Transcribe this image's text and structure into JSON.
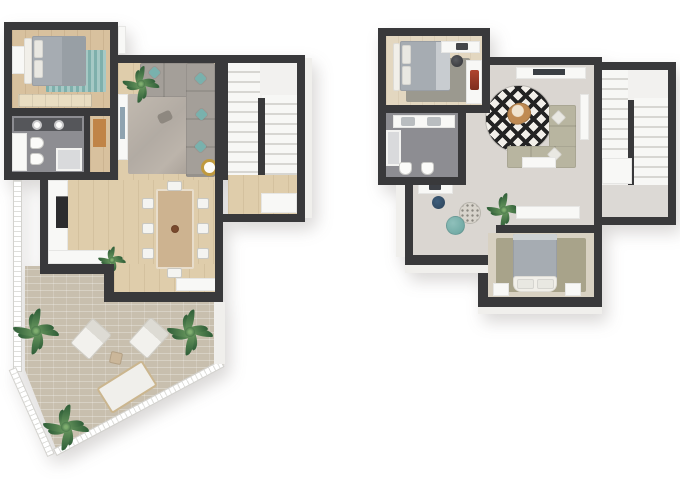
{
  "meta": {
    "image_type": "3d-top-down-floor-plan-render",
    "background": "#ffffff",
    "plan_count": 2
  },
  "palette": {
    "wall": "#39393b",
    "wood": "#d8c19e",
    "wood_light": "#dfcdab",
    "wood_pale": "#e3d7c0",
    "gray_floor": "#8d8d92",
    "light_floor": "#dad6d1",
    "terrace": "#c8bfae",
    "white": "#f8f8f6",
    "exterior": "#f0efec",
    "sofa_gray": "#a49f99",
    "rug_gray": "#b2aba3",
    "rug_dark": "#9b998f",
    "teal": "#79b1ad",
    "navy": "#2c4258",
    "olive": "#b8b5a0",
    "rug_olive": "#a8a38a",
    "tan": "#bf8a52",
    "gold": "#c09a3e",
    "plant_light": "#6b9a60",
    "plant_dark": "#2f5e38",
    "bed_gray": "#a6acb2",
    "appliance": "#2c2c2e",
    "counter_dark": "#55565a",
    "door_wood": "#c08447",
    "step_light": "#f7f7f5",
    "step_shadow": "#d7d6d2"
  },
  "plans": [
    {
      "id": "lower-floor",
      "position": "left",
      "rooms": [
        "bedroom",
        "bathroom",
        "hall-closet",
        "living-room",
        "dining-room",
        "kitchen",
        "staircase",
        "terrace"
      ],
      "furniture": [
        "double-bed",
        "striped-teal-rug",
        "wardrobe",
        "desk",
        "double-sink-vanity",
        "toilet",
        "bidet",
        "shower",
        "corner-sofa",
        "teal-pillows",
        "area-rug",
        "tv-sideboard",
        "gold-side-table",
        "dining-table",
        "dining-chairs-x8",
        "kitchen-tall-units",
        "counter-plant",
        "u-shaped-stairs",
        "palm-plants-x3",
        "lounge-chairs-x2",
        "outdoor-daybed",
        "outdoor-side-table",
        "perimeter-railing"
      ]
    },
    {
      "id": "upper-floor",
      "position": "right",
      "rooms": [
        "bedroom-front",
        "bathroom",
        "lounge",
        "hallway",
        "bedroom-back",
        "staircase"
      ],
      "furniture": [
        "double-bed",
        "dark-rug",
        "desk",
        "desk-chair",
        "wardrobe",
        "double-sink-vanity",
        "shower",
        "toilet",
        "bidet",
        "tv-console",
        "round-diamond-rug",
        "tan-accent-chair",
        "corner-sofa",
        "coffee-table",
        "work-desk",
        "office-chair",
        "teal-pouf",
        "dotted-pouf",
        "plant",
        "sideboard",
        "bed-with-white-headboard",
        "nightstands-x2",
        "u-shaped-stairs"
      ]
    }
  ]
}
